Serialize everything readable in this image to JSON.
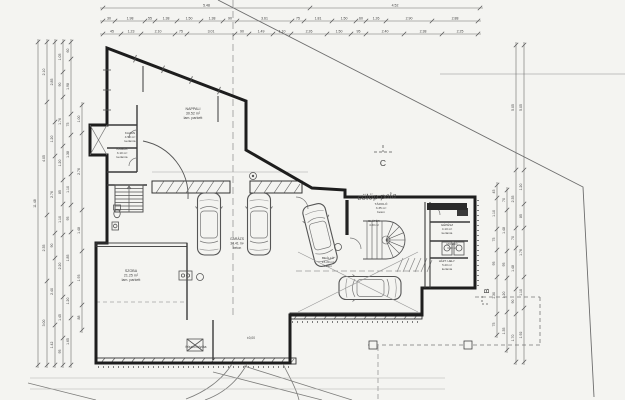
{
  "drawing": {
    "type": "architectural floor plan (scanned blueprint)",
    "colors": {
      "paper": "#f4f4f1",
      "wall": "#222222",
      "line": "#5f5f5f",
      "dim": "#6b6b6b",
      "faint": "#9a9a9a",
      "text": "#3c3c3c"
    }
  },
  "section_markers": [
    {
      "label": "C"
    },
    {
      "label": "B"
    }
  ],
  "labels": [
    {
      "name": "room-label-living",
      "x": 193,
      "y": 110,
      "size": 3.6,
      "lines": [
        "NAPPALI",
        "30.52 m²",
        "lam. parkett"
      ]
    },
    {
      "name": "room-label-szoba",
      "x": 131,
      "y": 272,
      "size": 3.6,
      "lines": [
        "SZOBA",
        "21.25 m²",
        "lam. parkett"
      ]
    },
    {
      "name": "room-label-kazan",
      "x": 130,
      "y": 134,
      "size": 3.1,
      "lines": [
        "KAZÁN",
        "4.50 m²",
        "kerámia"
      ]
    },
    {
      "name": "room-label-kamra",
      "x": 122,
      "y": 150,
      "size": 3.1,
      "lines": [
        "KAMRA",
        "3.10 m²",
        "kerámia"
      ]
    },
    {
      "name": "room-label-garazs",
      "x": 237,
      "y": 240,
      "size": 3.4,
      "lines": [
        "GARÁZS",
        "34.41 m²",
        "beton"
      ]
    },
    {
      "name": "room-label-tarolo",
      "x": 381,
      "y": 205,
      "size": 3.1,
      "lines": [
        "TÁROLÓ",
        "3.35 m²",
        "beton"
      ]
    },
    {
      "name": "room-label-beallo",
      "x": 328,
      "y": 259,
      "size": 3.1,
      "lines": [
        "BEÁLLÓ",
        "15.20 m²",
        "beton"
      ]
    },
    {
      "name": "room-label-gepesz",
      "x": 447,
      "y": 226,
      "size": 3.0,
      "lines": [
        "GÉPÉSZ",
        "4.10 m²",
        "kerámia"
      ]
    },
    {
      "name": "room-label-mosdo",
      "x": 452,
      "y": 245,
      "size": 2.9,
      "lines": [
        "MOSDÓ",
        "3.60 m²"
      ]
    },
    {
      "name": "room-label-haztartasi",
      "x": 447,
      "y": 262,
      "size": 2.9,
      "lines": [
        "HÁZT. HELY.",
        "5.20 m²",
        "kerámia"
      ]
    },
    {
      "name": "room-label-eloter",
      "x": 374,
      "y": 222,
      "size": 2.9,
      "lines": [
        "ELŐTÉR",
        "4.20 m²"
      ]
    },
    {
      "name": "drain-label",
      "x": 196,
      "y": 348,
      "size": 3.2,
      "lines": [
        "felszíni folyóka"
      ]
    },
    {
      "name": "level-marker-label",
      "x": 251,
      "y": 339,
      "size": 3.2,
      "lines": [
        "±0,00"
      ]
    },
    {
      "name": "handwritten-note",
      "x": 377,
      "y": 199,
      "size": 7.5,
      "italic": true,
      "rotate": -3,
      "lines": [
        "cölöp pala"
      ]
    },
    {
      "name": "section-marker-c",
      "x": 383,
      "y": 166,
      "size": 8.5,
      "lines": [
        "C"
      ]
    },
    {
      "name": "section-marker-b",
      "x": 489,
      "y": 291,
      "size": 7.5,
      "rotate": -90,
      "lines": [
        "B"
      ]
    }
  ],
  "dimensions": {
    "chains": [
      {
        "name": "top-overall",
        "dir": "h",
        "pos": 8,
        "from": 103,
        "to": 480,
        "segs": [
          {
            "r": 207,
            "t": "5.48"
          },
          {
            "r": 170,
            "t": "4.52"
          }
        ]
      },
      {
        "name": "top-row-2",
        "dir": "h",
        "pos": 21,
        "from": 103,
        "to": 478,
        "segs": [
          {
            "r": 12,
            "t": "30"
          },
          {
            "r": 30,
            "t": "1.98"
          },
          {
            "r": 10,
            "t": "55"
          },
          {
            "r": 22,
            "t": "1.38"
          },
          {
            "r": 24,
            "t": "1.50"
          },
          {
            "r": 22,
            "t": "1.38"
          },
          {
            "r": 14,
            "t": "90"
          },
          {
            "r": 55,
            "t": "3.61"
          },
          {
            "r": 12,
            "t": "75"
          },
          {
            "r": 28,
            "t": "1.81"
          },
          {
            "r": 24,
            "t": "1.50"
          },
          {
            "r": 10,
            "t": "60"
          },
          {
            "r": 20,
            "t": "1.26"
          },
          {
            "r": 46,
            "t": "2.90"
          },
          {
            "r": 46,
            "t": "2.88"
          }
        ]
      },
      {
        "name": "top-row-3",
        "dir": "h",
        "pos": 34,
        "from": 103,
        "to": 478,
        "segs": [
          {
            "r": 18,
            "t": "45"
          },
          {
            "r": 20,
            "t": "1.23"
          },
          {
            "r": 34,
            "t": "2.10"
          },
          {
            "r": 12,
            "t": "75"
          },
          {
            "r": 48,
            "t": "3.01"
          },
          {
            "r": 14,
            "t": "90"
          },
          {
            "r": 24,
            "t": "1.49"
          },
          {
            "r": 18,
            "t": "1.10"
          },
          {
            "r": 36,
            "t": "2.26"
          },
          {
            "r": 24,
            "t": "1.50"
          },
          {
            "r": 15,
            "t": "95"
          },
          {
            "r": 38,
            "t": "2.40"
          },
          {
            "r": 38,
            "t": "2.38"
          },
          {
            "r": 36,
            "t": "2.25"
          }
        ]
      },
      {
        "name": "left-1",
        "dir": "v",
        "pos": 38,
        "from": 42,
        "to": 365,
        "segs": [
          {
            "r": 323,
            "t": "11.48"
          }
        ]
      },
      {
        "name": "left-2",
        "dir": "v",
        "pos": 47,
        "from": 42,
        "to": 365,
        "segs": [
          {
            "r": 60,
            "t": "2.10"
          },
          {
            "r": 113,
            "t": "4.05"
          },
          {
            "r": 66,
            "t": "2.35"
          },
          {
            "r": 84,
            "t": "3.00"
          }
        ]
      },
      {
        "name": "left-3",
        "dir": "v",
        "pos": 55,
        "from": 42,
        "to": 365,
        "segs": [
          {
            "r": 80,
            "t": "2.85"
          },
          {
            "r": 34,
            "t": "1.20"
          },
          {
            "r": 77,
            "t": "2.76"
          },
          {
            "r": 25,
            "t": "90"
          },
          {
            "r": 67,
            "t": "2.40"
          },
          {
            "r": 40,
            "t": "1.42"
          }
        ]
      },
      {
        "name": "left-4",
        "dir": "v",
        "pos": 63,
        "from": 42,
        "to": 365,
        "segs": [
          {
            "r": 30,
            "t": "1.05"
          },
          {
            "r": 25,
            "t": "90"
          },
          {
            "r": 49,
            "t": "1.76"
          },
          {
            "r": 34,
            "t": "1.20"
          },
          {
            "r": 24,
            "t": "85"
          },
          {
            "r": 31,
            "t": "1.10"
          },
          {
            "r": 62,
            "t": "2.20"
          },
          {
            "r": 41,
            "t": "1.45"
          },
          {
            "r": 27,
            "t": "95"
          }
        ]
      },
      {
        "name": "left-5",
        "dir": "v",
        "pos": 71,
        "from": 42,
        "to": 365,
        "segs": [
          {
            "r": 17,
            "t": "60"
          },
          {
            "r": 55,
            "t": "1.98"
          },
          {
            "r": 21,
            "t": "75"
          },
          {
            "r": 39,
            "t": "1.38"
          },
          {
            "r": 31,
            "t": "1.10"
          },
          {
            "r": 27,
            "t": "95"
          },
          {
            "r": 52,
            "t": "1.85"
          },
          {
            "r": 34,
            "t": "1.20"
          },
          {
            "r": 47,
            "t": "1.65"
          }
        ]
      },
      {
        "name": "left-6",
        "dir": "v",
        "pos": 82,
        "from": 105,
        "to": 330,
        "segs": [
          {
            "r": 28,
            "t": "1.00"
          },
          {
            "r": 77,
            "t": "2.76"
          },
          {
            "r": 41,
            "t": "1.48"
          },
          {
            "r": 54,
            "t": "1.93"
          },
          {
            "r": 25,
            "t": "88"
          }
        ]
      },
      {
        "name": "right-outer-1",
        "dir": "v",
        "pos": 516,
        "from": 45,
        "to": 362,
        "segs": [
          {
            "r": 125,
            "t": "5.05"
          },
          {
            "r": 58,
            "t": "2.35"
          },
          {
            "r": 20,
            "t": "70"
          },
          {
            "r": 41,
            "t": "1.48"
          },
          {
            "r": 25,
            "t": "90"
          },
          {
            "r": 48,
            "t": "1.70"
          }
        ]
      },
      {
        "name": "right-outer-2",
        "dir": "v",
        "pos": 524,
        "from": 45,
        "to": 362,
        "segs": [
          {
            "r": 125,
            "t": "5.05"
          },
          {
            "r": 34,
            "t": "1.20"
          },
          {
            "r": 24,
            "t": "85"
          },
          {
            "r": 49,
            "t": "1.76"
          },
          {
            "r": 31,
            "t": "1.10"
          },
          {
            "r": 54,
            "t": "1.92"
          }
        ]
      },
      {
        "name": "right-inner-1",
        "dir": "v",
        "pos": 507,
        "from": 190,
        "to": 350,
        "segs": [
          {
            "r": 20,
            "t": "70"
          },
          {
            "r": 41,
            "t": "1.48"
          },
          {
            "r": 27,
            "t": "95"
          },
          {
            "r": 34,
            "t": "1.20"
          },
          {
            "r": 38,
            "t": "1.35"
          }
        ]
      },
      {
        "name": "right-inner-2",
        "dir": "v",
        "pos": 497,
        "from": 185,
        "to": 335,
        "segs": [
          {
            "r": 13,
            "t": "45"
          },
          {
            "r": 31,
            "t": "1.10"
          },
          {
            "r": 21,
            "t": "75"
          },
          {
            "r": 27,
            "t": "95"
          },
          {
            "r": 37,
            "t": "1.30"
          },
          {
            "r": 21,
            "t": "75"
          }
        ]
      }
    ]
  }
}
